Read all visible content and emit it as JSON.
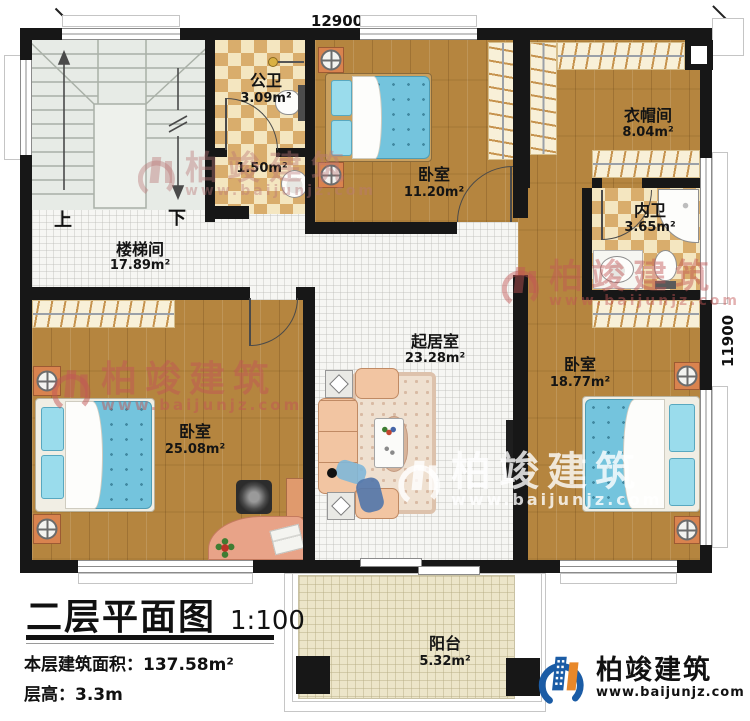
{
  "plan": {
    "dimensions": {
      "top": "12900",
      "right": "11900"
    },
    "stairs": {
      "up": "上",
      "down": "下"
    },
    "rooms": {
      "stairwell": {
        "name": "楼梯间",
        "area": "17.89m²"
      },
      "public_bath": {
        "name": "公卫",
        "area": "3.09m²"
      },
      "wash_nook": {
        "area": "1.50m²"
      },
      "bedroom_top": {
        "name": "卧室",
        "area": "11.20m²"
      },
      "cloakroom": {
        "name": "衣帽间",
        "area": "8.04m²"
      },
      "inner_bath": {
        "name": "内卫",
        "area": "3.65m²"
      },
      "bedroom_right": {
        "name": "卧室",
        "area": "18.77m²"
      },
      "bedroom_left": {
        "name": "卧室",
        "area": "25.08m²"
      },
      "living_room": {
        "name": "起居室",
        "area": "23.28m²"
      },
      "balcony": {
        "name": "阳台",
        "area": "5.32m²"
      }
    }
  },
  "title_block": {
    "title": "二层平面图",
    "scale": "1:100",
    "floor_area": "本层建筑面积：137.58m²",
    "floor_height": "层高：3.3m"
  },
  "brand": {
    "name": "柏竣建筑",
    "url": "www.baijunjz.com"
  },
  "colors": {
    "brand_blue": "#1b5ca5",
    "brand_orange": "#e8882a",
    "watermark_red": "#c05656",
    "wood_floor": "#b5853f",
    "tile_dark": "#d9ad6c",
    "tile_light": "#f4e6c0",
    "bed_blue": "#74c4dd"
  }
}
